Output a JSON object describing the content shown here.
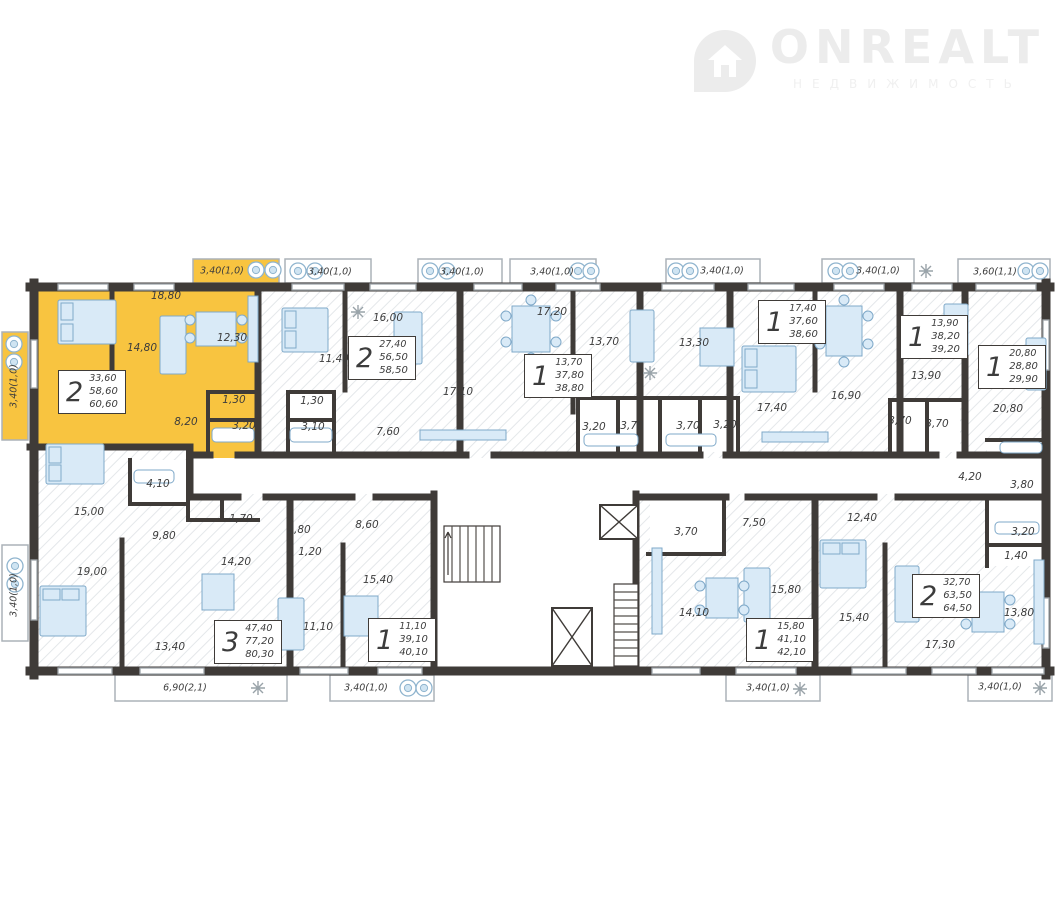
{
  "logo": {
    "title": "ONREALT",
    "subtitle": "НЕДВИЖИМОСТЬ",
    "icon": "house-pin-icon",
    "color": "#ececec"
  },
  "colors": {
    "highlight_apartment": "#F8C440",
    "walls": "#3F3B38",
    "furniture_fill": "#D9EAF7",
    "furniture_stroke": "#7FA9C9",
    "hatch": "#E4E7EA",
    "label_text": "#3C3C3C",
    "balcony_border": "#ABB2B8"
  },
  "apartments": [
    {
      "rooms": "2",
      "areas": [
        "33,60",
        "58,60",
        "60,60"
      ],
      "x": 58,
      "y": 370,
      "highlighted": true
    },
    {
      "rooms": "2",
      "areas": [
        "27,40",
        "56,50",
        "58,50"
      ],
      "x": 348,
      "y": 336,
      "highlighted": false
    },
    {
      "rooms": "1",
      "areas": [
        "13,70",
        "37,80",
        "38,80"
      ],
      "x": 524,
      "y": 354,
      "highlighted": false
    },
    {
      "rooms": "1",
      "areas": [
        "17,40",
        "37,60",
        "38,60"
      ],
      "x": 758,
      "y": 300,
      "highlighted": false
    },
    {
      "rooms": "1",
      "areas": [
        "13,90",
        "38,20",
        "39,20"
      ],
      "x": 900,
      "y": 315,
      "highlighted": false
    },
    {
      "rooms": "1",
      "areas": [
        "20,80",
        "28,80",
        "29,90"
      ],
      "x": 978,
      "y": 345,
      "highlighted": false
    },
    {
      "rooms": "3",
      "areas": [
        "47,40",
        "77,20",
        "80,30"
      ],
      "x": 214,
      "y": 620,
      "highlighted": false
    },
    {
      "rooms": "1",
      "areas": [
        "11,10",
        "39,10",
        "40,10"
      ],
      "x": 368,
      "y": 618,
      "highlighted": false
    },
    {
      "rooms": "1",
      "areas": [
        "15,80",
        "41,10",
        "42,10"
      ],
      "x": 746,
      "y": 618,
      "highlighted": false
    },
    {
      "rooms": "2",
      "areas": [
        "32,70",
        "63,50",
        "64,50"
      ],
      "x": 912,
      "y": 574,
      "highlighted": false
    }
  ],
  "room_labels": [
    {
      "t": "18,80",
      "x": 166,
      "y": 296
    },
    {
      "t": "14,80",
      "x": 142,
      "y": 348
    },
    {
      "t": "12,30",
      "x": 232,
      "y": 338
    },
    {
      "t": "1,30",
      "x": 234,
      "y": 400
    },
    {
      "t": "3,20",
      "x": 244,
      "y": 426
    },
    {
      "t": "8,20",
      "x": 186,
      "y": 422
    },
    {
      "t": "11,40",
      "x": 334,
      "y": 359
    },
    {
      "t": "16,00",
      "x": 388,
      "y": 318
    },
    {
      "t": "1,30",
      "x": 312,
      "y": 401
    },
    {
      "t": "3,10",
      "x": 313,
      "y": 427
    },
    {
      "t": "7,60",
      "x": 388,
      "y": 432
    },
    {
      "t": "17,10",
      "x": 458,
      "y": 392
    },
    {
      "t": "17,20",
      "x": 552,
      "y": 312
    },
    {
      "t": "13,70",
      "x": 604,
      "y": 342
    },
    {
      "t": "3,20",
      "x": 594,
      "y": 427
    },
    {
      "t": "3,70",
      "x": 632,
      "y": 426
    },
    {
      "t": "13,30",
      "x": 694,
      "y": 343
    },
    {
      "t": "3,70",
      "x": 688,
      "y": 426
    },
    {
      "t": "3,20",
      "x": 725,
      "y": 425
    },
    {
      "t": "17,40",
      "x": 772,
      "y": 408
    },
    {
      "t": "16,90",
      "x": 846,
      "y": 396
    },
    {
      "t": "13,90",
      "x": 926,
      "y": 376
    },
    {
      "t": "3,70",
      "x": 900,
      "y": 421
    },
    {
      "t": "3,70",
      "x": 937,
      "y": 424
    },
    {
      "t": "20,80",
      "x": 1008,
      "y": 409
    },
    {
      "t": "4,20",
      "x": 970,
      "y": 477
    },
    {
      "t": "3,80",
      "x": 1022,
      "y": 485
    },
    {
      "t": "15,00",
      "x": 89,
      "y": 512
    },
    {
      "t": "4,10",
      "x": 158,
      "y": 484
    },
    {
      "t": "9,80",
      "x": 164,
      "y": 536
    },
    {
      "t": "1,70",
      "x": 241,
      "y": 519
    },
    {
      "t": "14,20",
      "x": 236,
      "y": 562
    },
    {
      "t": "19,00",
      "x": 92,
      "y": 572
    },
    {
      "t": "13,40",
      "x": 170,
      "y": 647
    },
    {
      "t": "2,80",
      "x": 299,
      "y": 530
    },
    {
      "t": "1,20",
      "x": 310,
      "y": 552
    },
    {
      "t": "8,60",
      "x": 367,
      "y": 525
    },
    {
      "t": "15,40",
      "x": 378,
      "y": 580
    },
    {
      "t": "11,10",
      "x": 318,
      "y": 627
    },
    {
      "t": "3,70",
      "x": 686,
      "y": 532
    },
    {
      "t": "7,50",
      "x": 754,
      "y": 523
    },
    {
      "t": "14,10",
      "x": 694,
      "y": 613
    },
    {
      "t": "15,80",
      "x": 786,
      "y": 590
    },
    {
      "t": "12,40",
      "x": 862,
      "y": 518
    },
    {
      "t": "15,40",
      "x": 854,
      "y": 618
    },
    {
      "t": "17,30",
      "x": 940,
      "y": 645
    },
    {
      "t": "13,80",
      "x": 1019,
      "y": 613
    },
    {
      "t": "3,20",
      "x": 1023,
      "y": 532
    },
    {
      "t": "1,40",
      "x": 1016,
      "y": 556
    }
  ],
  "balcony_labels": [
    {
      "t": "3,40(1,0)",
      "x": 222,
      "y": 271
    },
    {
      "t": "3,40(1,0)",
      "x": 330,
      "y": 272
    },
    {
      "t": "3,40(1,0)",
      "x": 462,
      "y": 272
    },
    {
      "t": "3,40(1,0)",
      "x": 552,
      "y": 272
    },
    {
      "t": "3,40(1,0)",
      "x": 722,
      "y": 271
    },
    {
      "t": "3,40(1,0)",
      "x": 878,
      "y": 271
    },
    {
      "t": "3,60(1,1)",
      "x": 995,
      "y": 272
    },
    {
      "t": "3,40(1,0)",
      "x": 14,
      "y": 386,
      "vert": true
    },
    {
      "t": "3,40(1,0)",
      "x": 14,
      "y": 595,
      "vert": true
    },
    {
      "t": "6,90(2,1)",
      "x": 185,
      "y": 688
    },
    {
      "t": "3,40(1,0)",
      "x": 366,
      "y": 688
    },
    {
      "t": "3,40(1,0)",
      "x": 768,
      "y": 688
    },
    {
      "t": "3,40(1,0)",
      "x": 1000,
      "y": 687
    }
  ],
  "icons": {
    "logo_pin": "house-pin-icon",
    "balcony_appliance": "washing-machine-icon",
    "plants": "plant-icon",
    "lift": "elevator-icon",
    "stairs": "stairs-icon"
  }
}
